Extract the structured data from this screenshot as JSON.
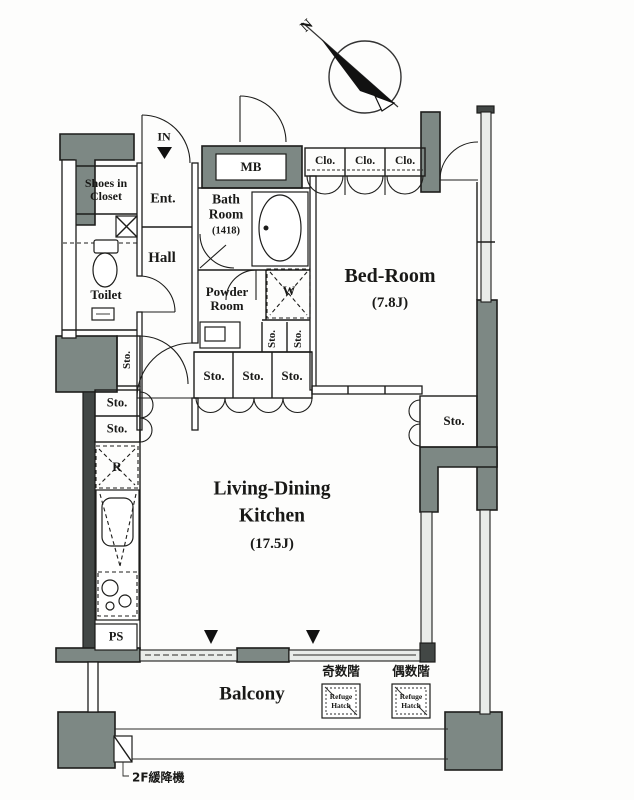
{
  "labels": {
    "north": "N",
    "in_entrance": "IN",
    "meter_box": "MB",
    "shoes_in_closet": "Shoes in Closet",
    "ent": "Ent.",
    "hall": "Hall",
    "toilet": "Toilet",
    "bath_room": "Bath Room",
    "bath_room_size": "(1418)",
    "powder_room": "Powder Room",
    "washer": "W",
    "closet": "Clo.",
    "bed_room": "Bed-Room",
    "bed_room_size": "(7.8J)",
    "storage": "Sto.",
    "refrigerator": "R",
    "pipe_space": "PS",
    "ldk_line1": "Living-Dining",
    "ldk_line2": "Kitchen",
    "ldk_size": "(17.5J)",
    "balcony": "Balcony",
    "odd_floors": "奇数階",
    "even_floors": "偶数階",
    "refuge_hatch": "Refuge Hatch",
    "escape_device": "2F緩降機"
  },
  "colors": {
    "wall_fill": "#7d8884",
    "dark_wall": "#424745",
    "line": "#1d1d1b",
    "window_band": "#e9ece9",
    "background": "#fdfdfc"
  }
}
